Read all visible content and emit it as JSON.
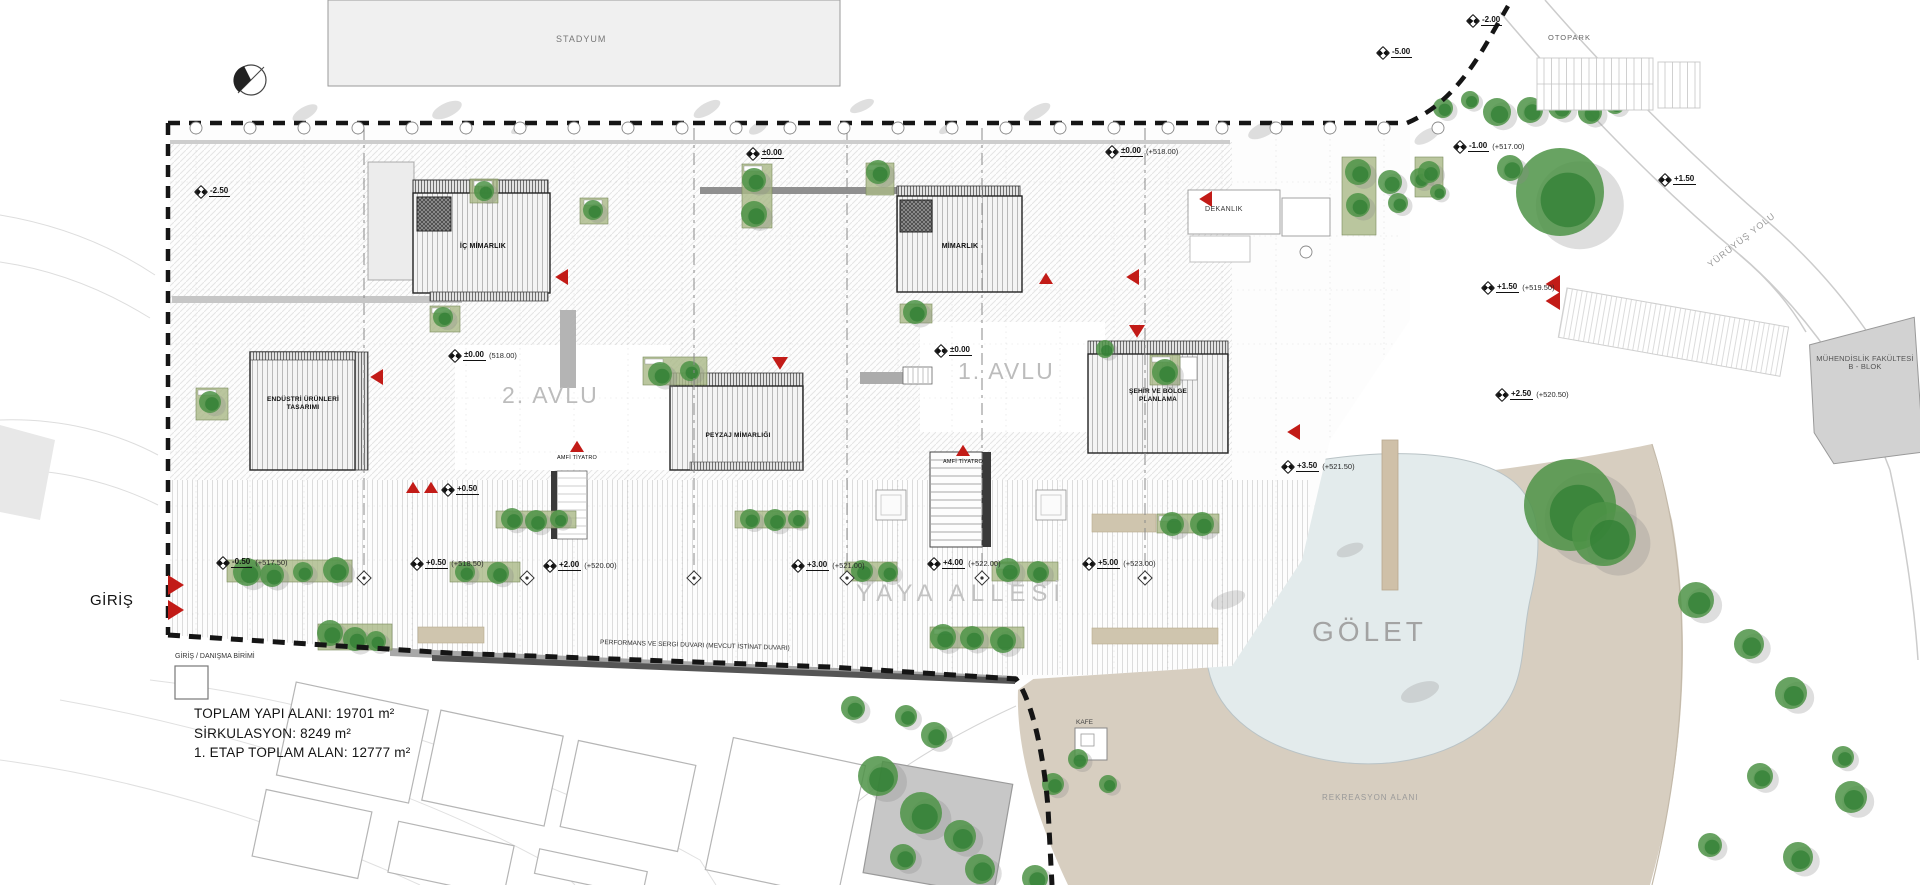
{
  "plan": {
    "stadium": "STADYUM",
    "entrance": "GİRİŞ",
    "entrance_unit": "GİRİŞ / DANIŞMA BİRİMİ",
    "stats": [
      "TOPLAM YAPI ALANI: 19701 m²",
      "SİRKULASYON: 8249 m²",
      "1. ETAP TOPLAM ALAN: 12777 m²"
    ],
    "buildings": {
      "ic_mimarlik": "İÇ MİMARLIK",
      "mimarlik": "MİMARLIK",
      "endustri1": "ENDÜSTRİ ÜRÜNLERİ",
      "endustri2": "TASARIMI",
      "peyzaj": "PEYZAJ MİMARLIĞI",
      "sehir1": "ŞEHİR VE BÖLGE",
      "sehir2": "PLANLAMA",
      "dekanlik": "DEKANLIK",
      "muhendislik1": "MÜHENDİSLİK FAKÜLTESİ",
      "muhendislik2": "B - BLOK",
      "kafe": "KAFE"
    },
    "areas": {
      "avlu1": "1. AVLU",
      "avlu2": "2. AVLU",
      "yaya": "YAYA ALLESİ",
      "golet": "GÖLET",
      "otopark": "OTOPARK",
      "yuruyus": "YÜRÜYÜŞ YOLU",
      "rekreasyon": "REKREASYON ALANI",
      "perf_wall": "PERFORMANS VE SERGİ DUVARI (MEVCUT İSTİNAT DUVARI)",
      "amfi1": "AMFİ TİYATRO",
      "amfi2": "AMFİ TİYATRO"
    },
    "elevation_markers": [
      {
        "value": "-2.50",
        "datum": "",
        "x": 196,
        "y": 186
      },
      {
        "value": "±0.00",
        "datum": "",
        "x": 748,
        "y": 148
      },
      {
        "value": "±0.00",
        "datum": "(+518.00)",
        "x": 1107,
        "y": 146
      },
      {
        "value": "-5.00",
        "datum": "",
        "x": 1378,
        "y": 47
      },
      {
        "value": "-2.00",
        "datum": "",
        "x": 1468,
        "y": 15
      },
      {
        "value": "-1.00",
        "datum": "(+517.00)",
        "x": 1455,
        "y": 141
      },
      {
        "value": "+1.50",
        "datum": "",
        "x": 1660,
        "y": 174
      },
      {
        "value": "+1.50",
        "datum": "(+519.50)",
        "x": 1483,
        "y": 282
      },
      {
        "value": "+2.50",
        "datum": "(+520.50)",
        "x": 1497,
        "y": 389
      },
      {
        "value": "+3.50",
        "datum": "(+521.50)",
        "x": 1283,
        "y": 461
      },
      {
        "value": "±0.00",
        "datum": "(518.00)",
        "x": 450,
        "y": 350
      },
      {
        "value": "±0.00",
        "datum": "",
        "x": 936,
        "y": 345
      },
      {
        "value": "-0.50",
        "datum": "(+517.50)",
        "x": 218,
        "y": 557
      },
      {
        "value": "+0.50",
        "datum": "(+518.50)",
        "x": 412,
        "y": 558
      },
      {
        "value": "+2.00",
        "datum": "(+520.00)",
        "x": 545,
        "y": 560
      },
      {
        "value": "+3.00",
        "datum": "(+521.00)",
        "x": 793,
        "y": 560
      },
      {
        "value": "+4.00",
        "datum": "(+522.00)",
        "x": 929,
        "y": 558
      },
      {
        "value": "+5.00",
        "datum": "(+523.00)",
        "x": 1084,
        "y": 558
      },
      {
        "value": "+0.50",
        "datum": "",
        "x": 443,
        "y": 484
      }
    ],
    "colors": {
      "tree": "#4e9347",
      "tree_dark": "#2e7d32",
      "accent_red": "#c21b17",
      "recreation_tan": "#d7cec0",
      "pond": "#e3ebec",
      "hedge": "#a9b886"
    }
  }
}
